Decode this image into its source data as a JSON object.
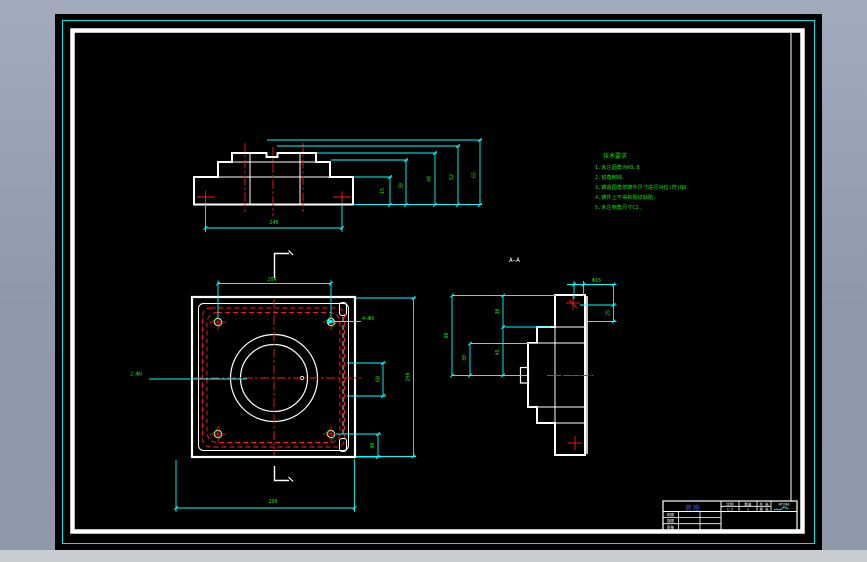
{
  "drawing": {
    "colors": {
      "cyan": "#00ffff",
      "red": "#ff1818",
      "green": "#00e800",
      "white": "#ffffff",
      "blue": "#2b4bff",
      "hatch": "#00dede",
      "paper": "#000000",
      "desktop": "#8d98ab"
    },
    "section_label": "A—A",
    "notes": {
      "title": "技术要求",
      "lines": [
        "1.未注圆角为R0.8",
        "2.锐角倒钝.",
        "3.铸造圆角按铸件尺寸进行对位(符)N8.",
        "4.铸件上不得有裂纹缺陷.",
        "5.未注倒角尺寸C2."
      ]
    },
    "front_view": {
      "height_dims": [
        "15",
        "30",
        "40",
        "52",
        "65"
      ],
      "bottom_dim": "245"
    },
    "plan_view": {
      "top_dim": "204",
      "bottom_dim": "290",
      "right_dim": "290",
      "slot_dim": "60",
      "corner_dim": "40",
      "holes_label": "4-Φ9",
      "left_label": "2-Φ8"
    },
    "side_view": {
      "dim_outer": "80",
      "dim_inner": "30",
      "dim_upper": "30",
      "dim_lower": "45",
      "dim_top": "Φ15",
      "dim_right": "25"
    },
    "title_block": {
      "part_name": "底座",
      "scale_label": "比例",
      "scale_value": "1:2",
      "qty_label": "数量",
      "qty_value": "1",
      "material_value": "HT200",
      "sheet_label": "共 张",
      "sheet_label2": "第 张",
      "row_labels": [
        "制图",
        "描图",
        "审核"
      ]
    }
  }
}
